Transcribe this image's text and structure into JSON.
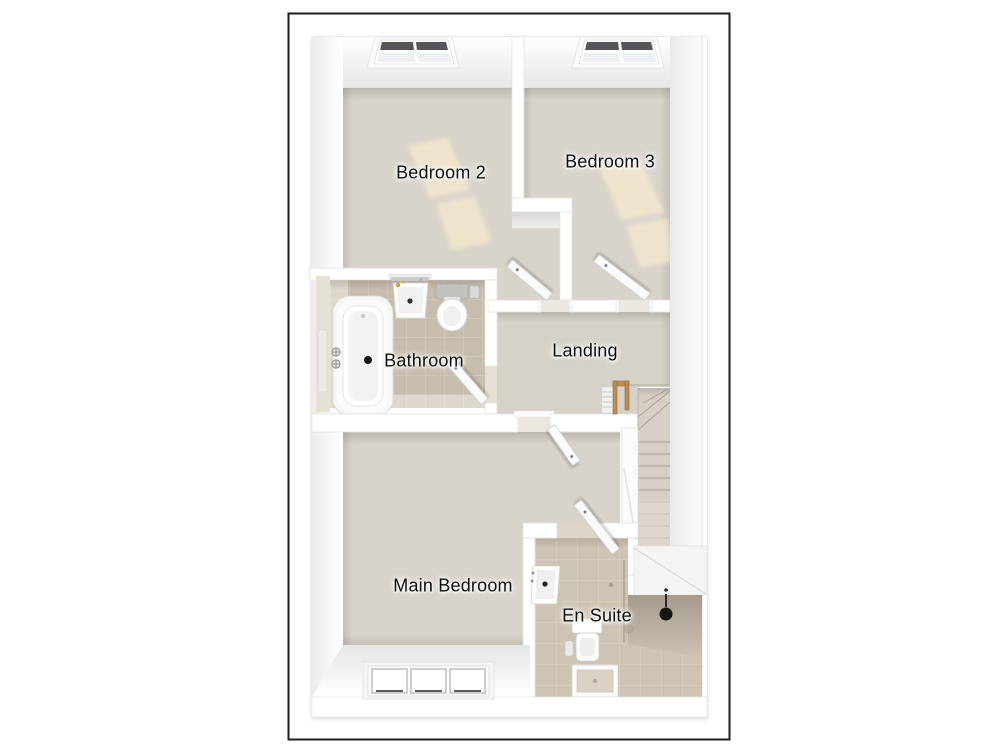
{
  "floor_plan": {
    "rooms": {
      "bedroom_2": {
        "label": "Bedroom 2"
      },
      "bedroom_3": {
        "label": "Bedroom 3"
      },
      "bathroom": {
        "label": "Bathroom"
      },
      "landing": {
        "label": "Landing"
      },
      "main_bedroom": {
        "label": "Main Bedroom"
      },
      "en_suite": {
        "label": "En Suite"
      }
    },
    "fixtures": [
      "bathtub-icon",
      "bathroom-sink-icon",
      "bathroom-toilet-icon",
      "ceiling-light-bathroom-icon",
      "ensuite-sink-icon",
      "ensuite-toilet-icon",
      "shower-tray-icon",
      "shower-head-icon",
      "staircase-icon",
      "banister-icon",
      "skylight-window-bedroom-2-icon",
      "skylight-window-bedroom-3-icon",
      "main-bedroom-window-icon",
      "door-bedroom-2-icon",
      "door-bedroom-3-icon",
      "door-bathroom-icon",
      "door-main-bedroom-icon",
      "door-en-suite-icon"
    ],
    "colors": {
      "plan_border": "#1e1e1e",
      "wall": "#ffffff",
      "carpet": "#d8d3cb",
      "bathroom_tile": "#c7bdae",
      "ensuite_tile": "#cdc4b4",
      "wood_banister": "#bd8a52",
      "sunlight_patch": "#f2e7cd"
    }
  }
}
